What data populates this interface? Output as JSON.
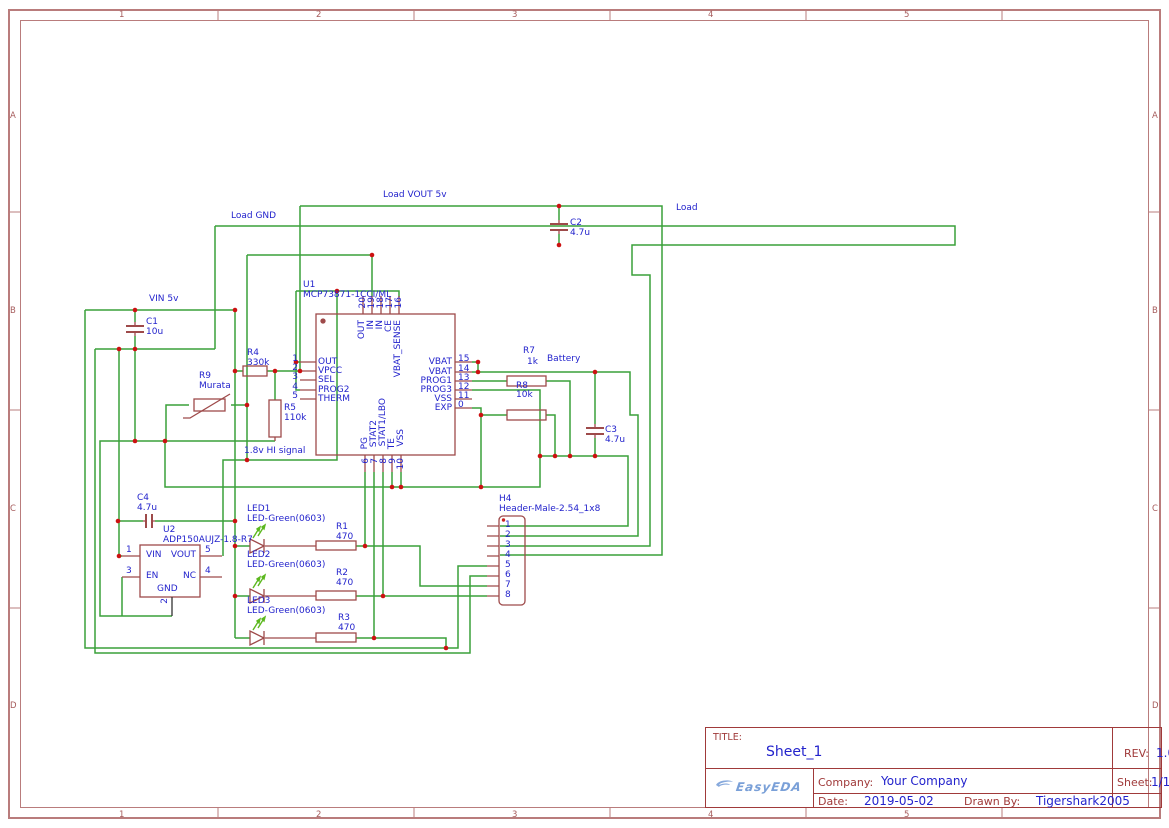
{
  "frame": {
    "columns": [
      "1",
      "2",
      "3",
      "4",
      "5"
    ],
    "rows": [
      "A",
      "B",
      "C",
      "D"
    ]
  },
  "title_block": {
    "title_label": "TITLE:",
    "title": "Sheet_1",
    "rev_label": "REV:",
    "rev": "1.0",
    "company_label": "Company:",
    "company": "Your Company",
    "sheet_label": "Sheet:",
    "sheet": "1/1",
    "date_label": "Date:",
    "date": "2019-05-02",
    "drawn_label": "Drawn By:",
    "drawn_by": "Tigershark2005",
    "logo": "EasyEDA"
  },
  "colors": {
    "wire": "#3aa13a",
    "symbol": "#9e4a4a",
    "junction": "#cc1111",
    "net_text": "#2323cc",
    "frame": "#b97c7c",
    "title_border": "#a03a3a",
    "logo_blue": "#7aa0d8",
    "led_arrow": "#5cb81f"
  },
  "schematic": {
    "texts": [
      {
        "n": "net-load-vout",
        "t": "Load VOUT 5v",
        "x": 383,
        "y": 190,
        "c": "serif"
      },
      {
        "n": "net-load-gnd",
        "t": "Load GND",
        "x": 231,
        "y": 211,
        "c": "serif"
      },
      {
        "n": "net-vin-5v",
        "t": "VIN 5v",
        "x": 149,
        "y": 294,
        "c": "serif"
      },
      {
        "n": "net-hi-signal",
        "t": "1.8v HI signal",
        "x": 244,
        "y": 446,
        "c": "serif"
      },
      {
        "n": "net-load",
        "t": "Load",
        "x": 676,
        "y": 203,
        "c": "big"
      },
      {
        "n": "net-battery",
        "t": "Battery",
        "x": 547,
        "y": 354,
        "c": "big"
      },
      {
        "n": "u1-ref",
        "t": "U1",
        "x": 303,
        "y": 280,
        "c": ""
      },
      {
        "n": "u1-value",
        "t": "MCP73871-1CCI/ML",
        "x": 303,
        "y": 290,
        "c": ""
      },
      {
        "n": "u1-pin1-name",
        "t": "OUT",
        "x": 318,
        "y": 357,
        "c": ""
      },
      {
        "n": "u1-pin2-name",
        "t": "VPCC",
        "x": 318,
        "y": 366,
        "c": "red"
      },
      {
        "n": "u1-pin3-name",
        "t": "SEL",
        "x": 318,
        "y": 375,
        "c": ""
      },
      {
        "n": "u1-pin4-name",
        "t": "PROG2",
        "x": 318,
        "y": 385,
        "c": ""
      },
      {
        "n": "u1-pin5-name",
        "t": "THERM",
        "x": 318,
        "y": 394,
        "c": ""
      },
      {
        "n": "u1-pin1-num",
        "t": "1",
        "x": 298,
        "y": 354,
        "c": "num end"
      },
      {
        "n": "u1-pin2-num",
        "t": "2",
        "x": 298,
        "y": 363,
        "c": "num end red"
      },
      {
        "n": "u1-pin3-num",
        "t": "3",
        "x": 298,
        "y": 372,
        "c": "num end"
      },
      {
        "n": "u1-pin4-num",
        "t": "4",
        "x": 298,
        "y": 382,
        "c": "num end"
      },
      {
        "n": "u1-pin5-num",
        "t": "5",
        "x": 298,
        "y": 391,
        "c": "num end"
      },
      {
        "n": "u1-pin15-name",
        "t": "VBAT",
        "x": 452,
        "y": 357,
        "c": "end"
      },
      {
        "n": "u1-pin14-name",
        "t": "VBAT",
        "x": 452,
        "y": 367,
        "c": "end"
      },
      {
        "n": "u1-pin13-name",
        "t": "PROG1",
        "x": 452,
        "y": 376,
        "c": "end"
      },
      {
        "n": "u1-pin12-name",
        "t": "PROG3",
        "x": 452,
        "y": 385,
        "c": "end"
      },
      {
        "n": "u1-pin11-name",
        "t": "VSS",
        "x": 452,
        "y": 394,
        "c": "end blk"
      },
      {
        "n": "u1-pin21-name",
        "t": "EXP",
        "x": 452,
        "y": 403,
        "c": "end"
      },
      {
        "n": "u1-pin15-num",
        "t": "15",
        "x": 458,
        "y": 354,
        "c": "num"
      },
      {
        "n": "u1-pin14-num",
        "t": "14",
        "x": 458,
        "y": 364,
        "c": "num"
      },
      {
        "n": "u1-pin13-num",
        "t": "13",
        "x": 458,
        "y": 373,
        "c": "num"
      },
      {
        "n": "u1-pin12-num",
        "t": "12",
        "x": 458,
        "y": 382,
        "c": "num"
      },
      {
        "n": "u1-pin11-num",
        "t": "11",
        "x": 458,
        "y": 391,
        "c": "num blk"
      },
      {
        "n": "u1-pin21-num",
        "t": "0",
        "x": 458,
        "y": 400,
        "c": "num"
      },
      {
        "n": "u1-pin20-name",
        "t": "OUT",
        "x": 357,
        "y": 320,
        "c": "rot"
      },
      {
        "n": "u1-pin19-name",
        "t": "IN",
        "x": 366,
        "y": 320,
        "c": "rot"
      },
      {
        "n": "u1-pin18-name",
        "t": "IN",
        "x": 375,
        "y": 320,
        "c": "rot"
      },
      {
        "n": "u1-pin17-name",
        "t": "CE",
        "x": 384,
        "y": 320,
        "c": "rot"
      },
      {
        "n": "u1-pin16-name",
        "t": "VBAT_SENSE",
        "x": 393,
        "y": 320,
        "c": "rot"
      },
      {
        "n": "u1-pin20-num",
        "t": "20",
        "x": 358,
        "y": 297,
        "c": "rot num"
      },
      {
        "n": "u1-pin19-num",
        "t": "19",
        "x": 367,
        "y": 297,
        "c": "rot num"
      },
      {
        "n": "u1-pin18-num",
        "t": "18",
        "x": 376,
        "y": 297,
        "c": "rot num"
      },
      {
        "n": "u1-pin17-num",
        "t": "17",
        "x": 385,
        "y": 297,
        "c": "rot num"
      },
      {
        "n": "u1-pin16-num",
        "t": "16",
        "x": 394,
        "y": 297,
        "c": "rot num"
      },
      {
        "n": "u1-pin6-name",
        "t": "PG",
        "x": 360,
        "y": 437,
        "c": "rot"
      },
      {
        "n": "u1-pin7-name",
        "t": "STAT2",
        "x": 369,
        "y": 420,
        "c": "rot"
      },
      {
        "n": "u1-pin8-name",
        "t": "STAT1/LBO",
        "x": 378,
        "y": 398,
        "c": "rot"
      },
      {
        "n": "u1-pin9-name",
        "t": "TE",
        "x": 387,
        "y": 438,
        "c": "rot"
      },
      {
        "n": "u1-pin10-name",
        "t": "VSS",
        "x": 396,
        "y": 429,
        "c": "rot blk"
      },
      {
        "n": "u1-pin6-num",
        "t": "6",
        "x": 361,
        "y": 458,
        "c": "rot num"
      },
      {
        "n": "u1-pin7-num",
        "t": "7",
        "x": 370,
        "y": 458,
        "c": "rot num"
      },
      {
        "n": "u1-pin8-num",
        "t": "8",
        "x": 379,
        "y": 458,
        "c": "rot num"
      },
      {
        "n": "u1-pin9-num",
        "t": "9",
        "x": 388,
        "y": 458,
        "c": "rot num"
      },
      {
        "n": "u1-pin10-num",
        "t": "10",
        "x": 396,
        "y": 458,
        "c": "rot num blk"
      },
      {
        "n": "r4-ref",
        "t": "R4",
        "x": 247,
        "y": 348,
        "c": ""
      },
      {
        "n": "r4-value",
        "t": "330k",
        "x": 247,
        "y": 358,
        "c": ""
      },
      {
        "n": "r9-ref",
        "t": "R9",
        "x": 199,
        "y": 371,
        "c": ""
      },
      {
        "n": "r9-value",
        "t": "Murata",
        "x": 199,
        "y": 381,
        "c": ""
      },
      {
        "n": "r5-ref",
        "t": "R5",
        "x": 284,
        "y": 403,
        "c": ""
      },
      {
        "n": "r5-value",
        "t": "110k",
        "x": 284,
        "y": 413,
        "c": ""
      },
      {
        "n": "r7-ref",
        "t": "R7",
        "x": 523,
        "y": 346,
        "c": ""
      },
      {
        "n": "r7-value",
        "t": "1k",
        "x": 527,
        "y": 357,
        "c": ""
      },
      {
        "n": "r8-ref",
        "t": "R8",
        "x": 516,
        "y": 381,
        "c": ""
      },
      {
        "n": "r8-value",
        "t": "10k",
        "x": 516,
        "y": 390,
        "c": ""
      },
      {
        "n": "c1-ref",
        "t": "C1",
        "x": 146,
        "y": 317,
        "c": ""
      },
      {
        "n": "c1-value",
        "t": "10u",
        "x": 146,
        "y": 327,
        "c": ""
      },
      {
        "n": "c2-ref",
        "t": "C2",
        "x": 570,
        "y": 218,
        "c": ""
      },
      {
        "n": "c2-value",
        "t": "4.7u",
        "x": 570,
        "y": 228,
        "c": ""
      },
      {
        "n": "c3-ref",
        "t": "C3",
        "x": 605,
        "y": 425,
        "c": ""
      },
      {
        "n": "c3-value",
        "t": "4.7u",
        "x": 605,
        "y": 435,
        "c": ""
      },
      {
        "n": "c4-ref",
        "t": "C4",
        "x": 137,
        "y": 493,
        "c": ""
      },
      {
        "n": "c4-value",
        "t": "4.7u",
        "x": 137,
        "y": 503,
        "c": ""
      },
      {
        "n": "r1-ref",
        "t": "R1",
        "x": 336,
        "y": 522,
        "c": ""
      },
      {
        "n": "r1-value",
        "t": "470",
        "x": 336,
        "y": 532,
        "c": ""
      },
      {
        "n": "r2-ref",
        "t": "R2",
        "x": 336,
        "y": 568,
        "c": ""
      },
      {
        "n": "r2-value",
        "t": "470",
        "x": 336,
        "y": 578,
        "c": ""
      },
      {
        "n": "r3-ref",
        "t": "R3",
        "x": 338,
        "y": 613,
        "c": ""
      },
      {
        "n": "r3-value",
        "t": "470",
        "x": 338,
        "y": 623,
        "c": ""
      },
      {
        "n": "led1-ref",
        "t": "LED1",
        "x": 247,
        "y": 504,
        "c": ""
      },
      {
        "n": "led1-value",
        "t": "LED-Green(0603)",
        "x": 247,
        "y": 514,
        "c": ""
      },
      {
        "n": "led2-ref",
        "t": "LED2",
        "x": 247,
        "y": 550,
        "c": ""
      },
      {
        "n": "led2-value",
        "t": "LED-Green(0603)",
        "x": 247,
        "y": 560,
        "c": ""
      },
      {
        "n": "led3-ref",
        "t": "LED3",
        "x": 247,
        "y": 596,
        "c": ""
      },
      {
        "n": "led3-value",
        "t": "LED-Green(0603)",
        "x": 247,
        "y": 606,
        "c": ""
      },
      {
        "n": "u2-ref",
        "t": "U2",
        "x": 163,
        "y": 525,
        "c": ""
      },
      {
        "n": "u2-value",
        "t": "ADP150AUJZ-1.8-R7",
        "x": 163,
        "y": 535,
        "c": ""
      },
      {
        "n": "u2-pin1-name",
        "t": "VIN",
        "x": 146,
        "y": 550,
        "c": ""
      },
      {
        "n": "u2-pin5-name",
        "t": "VOUT",
        "x": 196,
        "y": 550,
        "c": "end"
      },
      {
        "n": "u2-pin3-name",
        "t": "EN",
        "x": 146,
        "y": 571,
        "c": ""
      },
      {
        "n": "u2-pin4-name",
        "t": "NC",
        "x": 196,
        "y": 571,
        "c": "end"
      },
      {
        "n": "u2-gnd-name",
        "t": "GND",
        "x": 157,
        "y": 584,
        "c": "red serif"
      },
      {
        "n": "u2-pin1-num",
        "t": "1",
        "x": 126,
        "y": 545,
        "c": "num"
      },
      {
        "n": "u2-pin5-num",
        "t": "5",
        "x": 205,
        "y": 545,
        "c": "num"
      },
      {
        "n": "u2-pin3-num",
        "t": "3",
        "x": 126,
        "y": 566,
        "c": "num"
      },
      {
        "n": "u2-pin4-num",
        "t": "4",
        "x": 205,
        "y": 566,
        "c": "num"
      },
      {
        "n": "u2-pin2-num",
        "t": "2",
        "x": 160,
        "y": 598,
        "c": "rot num blk"
      },
      {
        "n": "h4-ref",
        "t": "H4",
        "x": 499,
        "y": 494,
        "c": ""
      },
      {
        "n": "h4-value",
        "t": "Header-Male-2.54_1x8",
        "x": 499,
        "y": 504,
        "c": ""
      },
      {
        "n": "h4-pin1-num",
        "t": "1",
        "x": 505,
        "y": 520,
        "c": ""
      },
      {
        "n": "h4-pin2-num",
        "t": "2",
        "x": 505,
        "y": 530,
        "c": ""
      },
      {
        "n": "h4-pin3-num",
        "t": "3",
        "x": 505,
        "y": 540,
        "c": ""
      },
      {
        "n": "h4-pin4-num",
        "t": "4",
        "x": 505,
        "y": 550,
        "c": ""
      },
      {
        "n": "h4-pin5-num",
        "t": "5",
        "x": 505,
        "y": 560,
        "c": ""
      },
      {
        "n": "h4-pin6-num",
        "t": "6",
        "x": 505,
        "y": 570,
        "c": ""
      },
      {
        "n": "h4-pin7-num",
        "t": "7",
        "x": 505,
        "y": 580,
        "c": ""
      },
      {
        "n": "h4-pin8-num",
        "t": "8",
        "x": 505,
        "y": 590,
        "c": ""
      }
    ]
  }
}
